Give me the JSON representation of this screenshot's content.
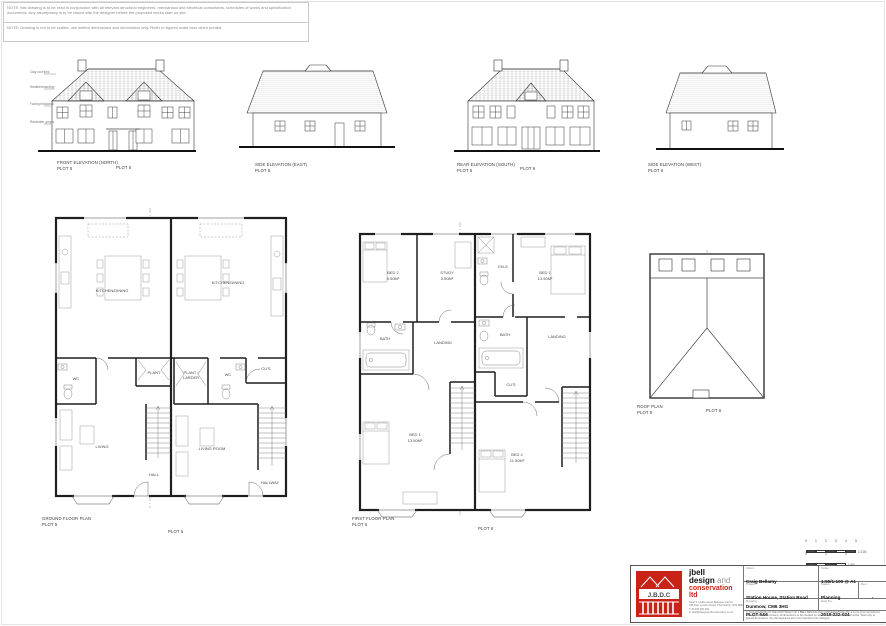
{
  "notes": {
    "note1": "NOTE: this drawing is to be read in conjunction with all relevant structural engineers, mechanical and electrical consultants, schedules of works and specification documents. Any discrepancy is to be raised with the designer before the proposed works start on site.",
    "note2": "NOTE: Drawing is not to be scaled; use written dimensions and information only. Refer to figured scale bars when printed."
  },
  "elevations": [
    {
      "title": "FRONT ELEVATION (NORTH)",
      "plot": "PLOT 5",
      "plot2": "PLOT 6",
      "annotations": [
        "Clay roof tiles",
        "Weatherboarding",
        "Facing brickwork",
        "Rainwater goods"
      ]
    },
    {
      "title": "SIDE ELEVATION (EAST)",
      "plot": "PLOT 5"
    },
    {
      "title": "REAR ELEVATION (SOUTH)",
      "plot": "PLOT 5",
      "plot2": "PLOT 6"
    },
    {
      "title": "SIDE ELEVATION (WEST)",
      "plot": "PLOT 6"
    }
  ],
  "plans": {
    "ground": {
      "title": "GROUND FLOOR PLAN",
      "plot": "PLOT 5",
      "plot2": "PLOT 6",
      "rooms5": {
        "kitchen": "KITCHEN/DINING",
        "wc": "WC",
        "plant": "PLANT",
        "living": "LIVING",
        "hall": "HALL"
      },
      "rooms6": {
        "kitchen": "KITCHEN/DINING",
        "plant1": "PLANT /",
        "plant2": "LARDER",
        "wc": "WC",
        "cups": "CU'S",
        "living": "LIVING ROOM",
        "hall": "HALLWAY"
      }
    },
    "first": {
      "title": "FIRST FLOOR PLAN",
      "plot": "PLOT 5",
      "plot2": "PLOT 6",
      "rooms5": {
        "bed2": "BED 2",
        "bed2area": "9.50M²",
        "study": "STUDY",
        "studyarea": "5.50M²",
        "bath": "BATH",
        "landing": "LANDING",
        "bed1": "BED 1",
        "bed1area": "13.50M²"
      },
      "rooms6": {
        "ens": "EN-S",
        "bed1": "BED 1",
        "bed1area": "13.50M²",
        "bath": "BATH",
        "cups": "CU'S",
        "landing": "LANDING",
        "bed2": "BED 2",
        "bed2area": "11.50M²"
      }
    },
    "roof": {
      "title": "ROOF PLAN",
      "plot": "PLOT 5",
      "plot2": "PLOT 6"
    }
  },
  "scalebars": {
    "bar1": {
      "ratio": "1:100",
      "ticks": [
        "0",
        "1",
        "2",
        "3",
        "4",
        "5"
      ]
    },
    "bar2": {
      "ratio": "1:50",
      "ticks": [
        "0",
        "1",
        "2"
      ]
    }
  },
  "titleblock": {
    "logo": {
      "acronym": "J.B.D.C"
    },
    "company": {
      "name1": "jbell",
      "name2": "design",
      "name2b": " and",
      "name3": "conservation ltd",
      "addr1": "Suite 5, Hollis House Business Centre",
      "addr2": "245 New London Road, Chelmsford, CM2 9BE",
      "tel": "T: 01245 200 000",
      "email": "E: jbell@designandconservation.co.uk"
    },
    "fields": {
      "client_label": "Client:",
      "client": "Craig Bellamy",
      "project_label": "Project:",
      "project1": "Station House, Station Road",
      "project2": "Dunmow, CM6 3HG",
      "drawing_label": "Drawing:",
      "drawing": "PLOT 5&6",
      "scale_label": "Scale:",
      "scale": "1:50/1:100 @ A1",
      "status_label": "Status:",
      "status": "Planning",
      "rev_label": "Rev:",
      "rev": "-",
      "dwgno_label": "Dwg No:",
      "dwgno": "2019-222-024"
    },
    "copyright": "© THIS DRAWING IS THE COPYRIGHT OF J.BELL DESIGN AND CONSERVATION LTD. It is not to be reproduced without prior written consent. All dimensions to be checked on site before commencement of works. Work only to figured dimensions. Any discrepancies are to be reported to the designer."
  },
  "colors": {
    "brand_red": "#c92318",
    "linework": "#1f1f1f"
  }
}
